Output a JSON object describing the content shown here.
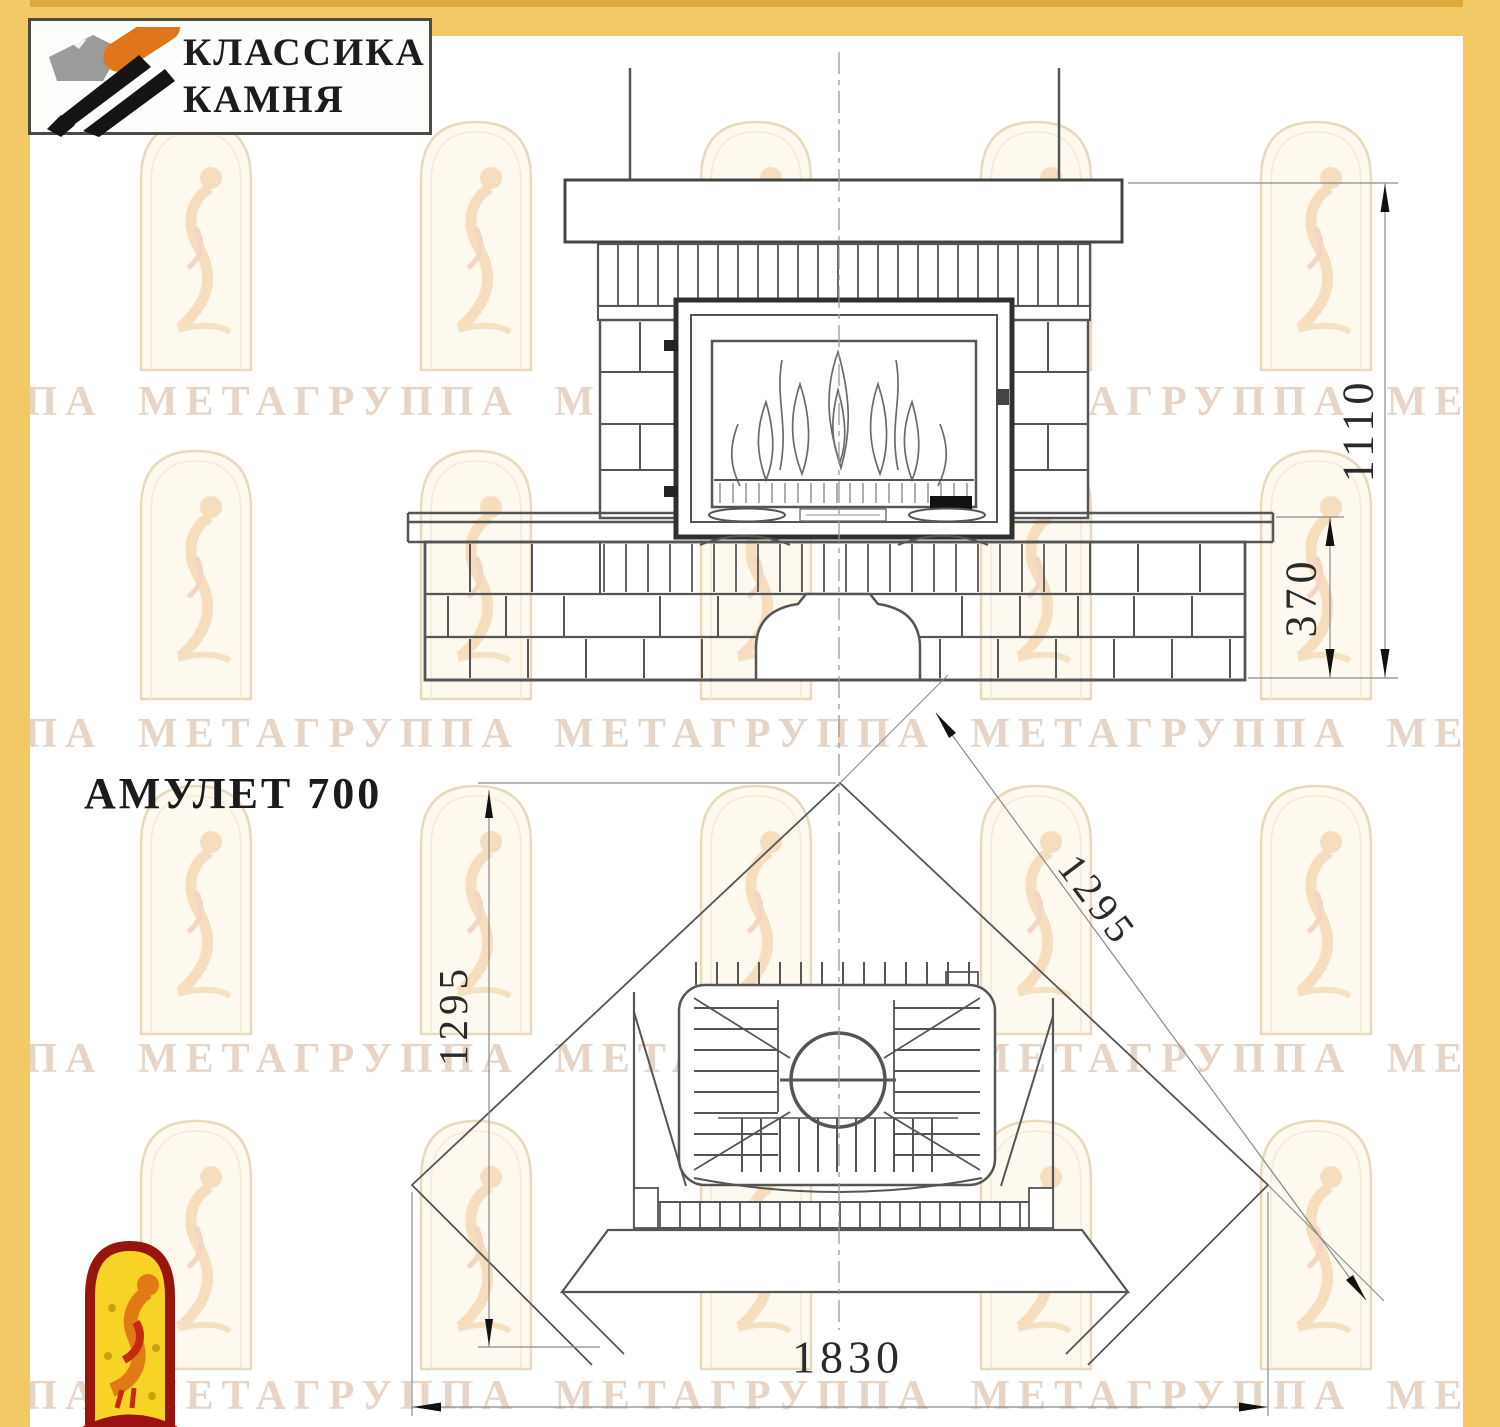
{
  "logo": {
    "line1": "КЛАССИКА",
    "line2": "КАМНЯ"
  },
  "page": {
    "model_title": "АМУЛЕТ 700"
  },
  "watermark": {
    "text": "УППА МЕТАГРУППА МЕТАГРУППА МЕТАГРУППА МЕТАГРУППА МЕТА"
  },
  "dimensions": {
    "front_total_height_mm": "1110",
    "bench_height_mm": "370",
    "plan_depth_mm": "1295",
    "plan_side_mm": "1295",
    "plan_front_width_mm": "1830"
  },
  "colors": {
    "page_border": "#f2c964",
    "watermark_text": "#e6d4c6",
    "drawing_line": "#555555",
    "logo_orange": "#e0761c",
    "mascot_red": "#9b1310",
    "mascot_yellow": "#f6d324"
  }
}
